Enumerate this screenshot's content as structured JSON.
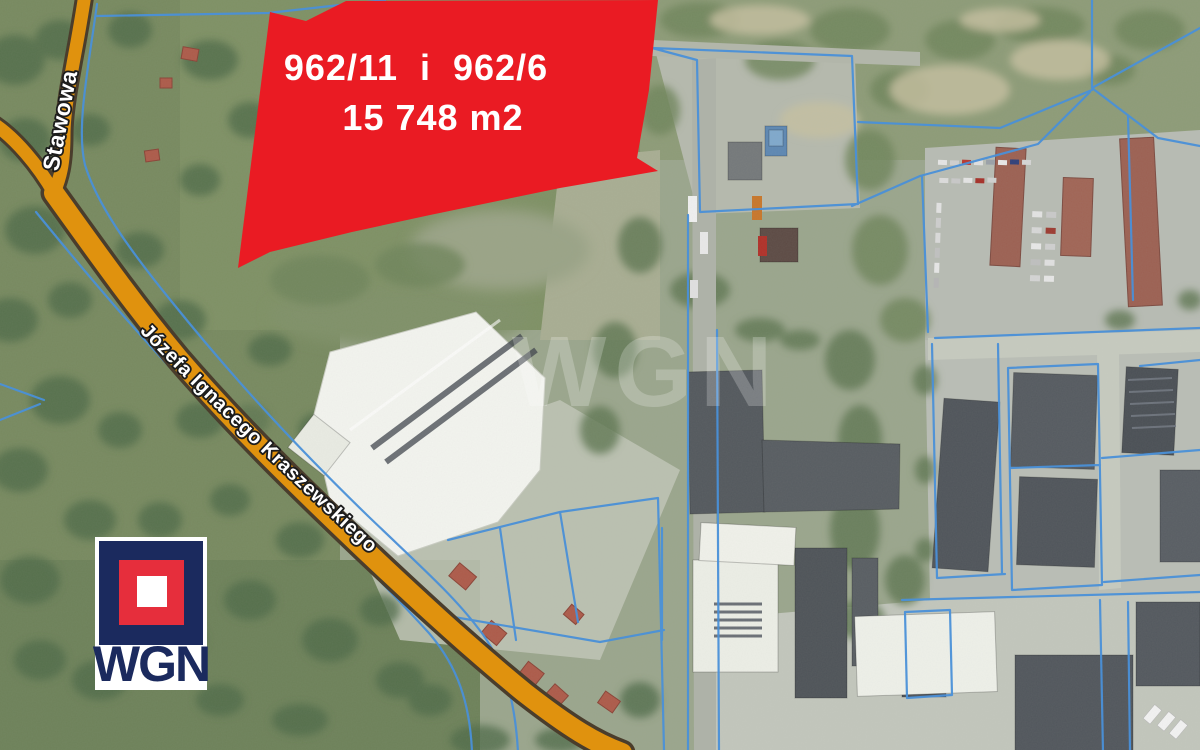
{
  "map": {
    "type": "satellite-cadastral-offer",
    "highlight": {
      "plot_numbers": "962/11  i  962/6",
      "area": "15 748 m2",
      "color": "#ea1b23"
    },
    "roads": {
      "highlight_color": "#e0920e",
      "casing_color": "#4a3d2c",
      "labels": [
        {
          "name": "Stawowa"
        },
        {
          "name": "Józefa Ignacego Kraszewskiego"
        }
      ]
    },
    "cadastral": {
      "line_color": "#4a90d8"
    },
    "watermark": {
      "text": "WGN"
    },
    "logo": {
      "text": "WGN",
      "navy": "#1b2a5e",
      "red": "#e62e3c"
    }
  }
}
